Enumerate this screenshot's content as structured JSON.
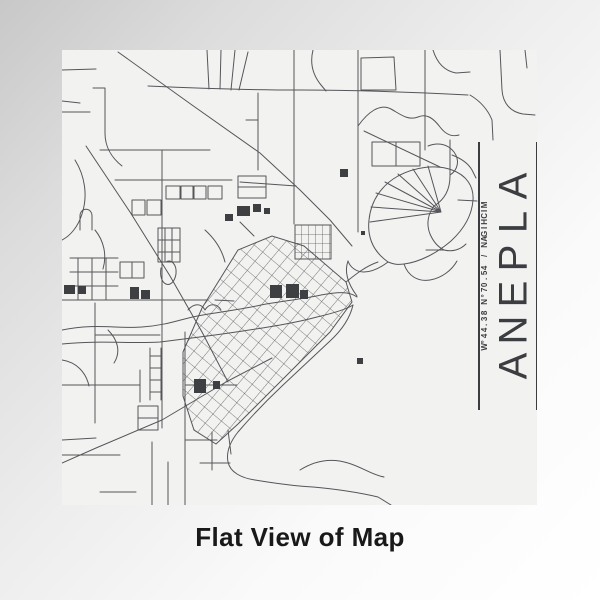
{
  "map_label": {
    "city": "ALPENA",
    "subtitle": "MICHIGAN / 45.07°N 83.44°W"
  },
  "caption": "Flat View of Map",
  "colors": {
    "background_start": "#c8c8c8",
    "background_mid": "#ededed",
    "background_end": "#ffffff",
    "paper": "#f2f2f0",
    "road": "#55565a",
    "building": "#3e3f43",
    "rule": "#3c3d41",
    "label_text": "#3c3d41",
    "caption_text": "#191919"
  }
}
